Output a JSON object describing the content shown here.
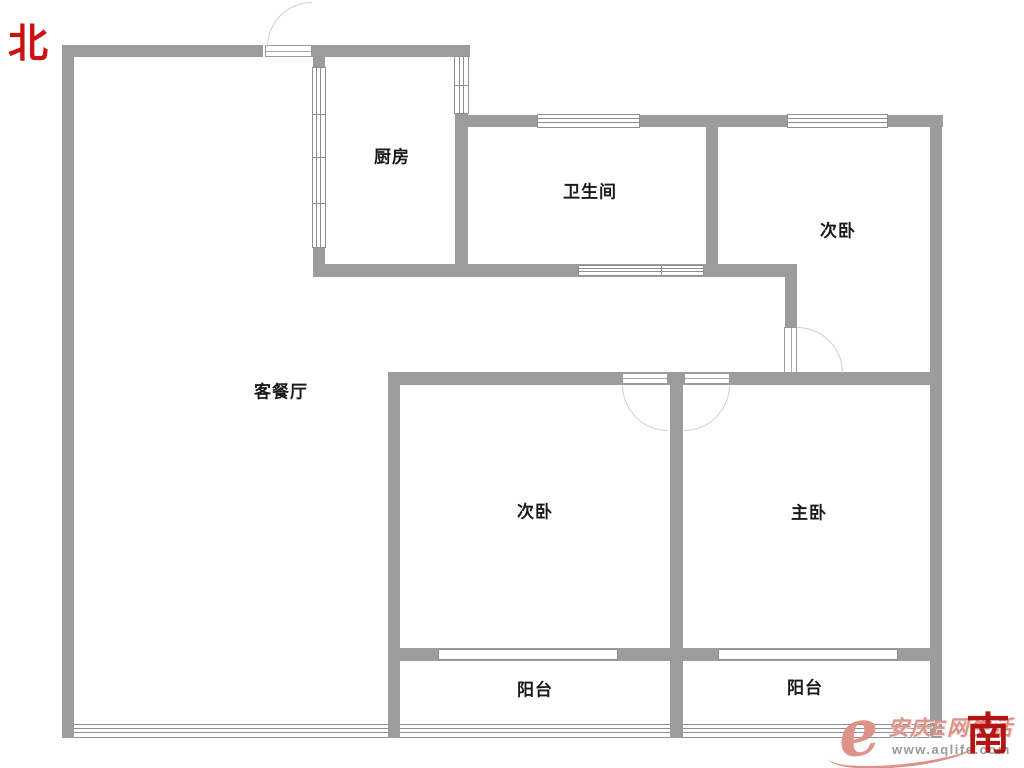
{
  "compass": {
    "north": "北",
    "south": "南"
  },
  "rooms": {
    "kitchen": "厨房",
    "bathroom": "卫生间",
    "bedroom_top": "次卧",
    "living_dining": "客餐厅",
    "bedroom_bottom": "次卧",
    "master_bedroom": "主卧",
    "balcony_left": "阳台",
    "balcony_right": "阳台"
  },
  "watermark": {
    "logo_letter": "e",
    "brand": "安庆E网生活",
    "url": "www.aqlife.com"
  },
  "colors": {
    "wall": "#9c9c9c",
    "compass_north": "#cc1111",
    "compass_south": "#b31515",
    "watermark_pink": "#dd928a",
    "watermark_gray": "#9a9a9a"
  }
}
